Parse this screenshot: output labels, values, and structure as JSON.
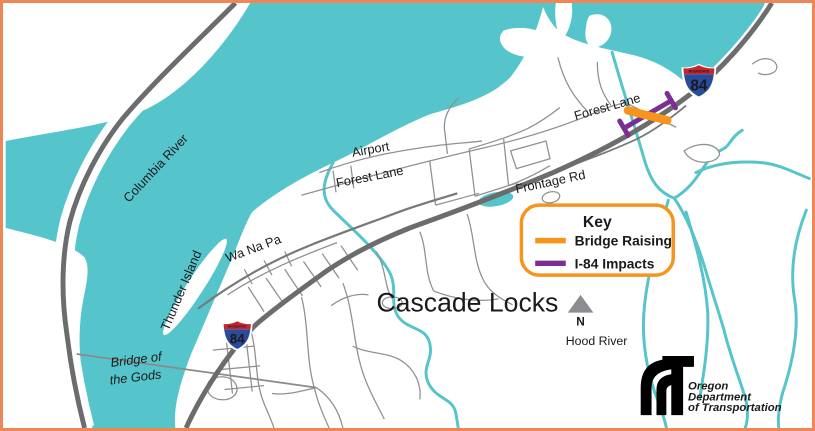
{
  "map": {
    "labels": {
      "columbia_river": "Columbia River",
      "thunder_island": "Thunder Island",
      "wa_na_pa": "Wa Na Pa",
      "airport": "Airport",
      "forest_lane_west": "Forest Lane",
      "forest_lane_northeast": "Forest Lane",
      "frontage_rd": "Frontage Rd",
      "bridge_of_the_gods_line1": "Bridge of",
      "bridge_of_the_gods_line2": "the Gods",
      "town": "Cascade Locks",
      "hood_river": "Hood River"
    },
    "north_arrow": {
      "label": "N"
    },
    "interstate_shield": {
      "top_text": "INTERSTATE",
      "number": "84"
    }
  },
  "key": {
    "title": "Key",
    "items": [
      {
        "label": "Bridge Raising",
        "color": "#F7941E"
      },
      {
        "label": "I-84 Impacts",
        "color": "#7C2E94"
      }
    ]
  },
  "logo": {
    "line1": "Oregon",
    "line2": "Department",
    "line3": "of Transportation"
  },
  "colors": {
    "water": "#55C5CB",
    "frame_border": "#EE8757",
    "highway_gray": "#6B6C6E",
    "minor_road_gray": "#8F9193",
    "bridge_raising_orange": "#F7941E",
    "i84_impacts_purple": "#7C2E94",
    "shield_red": "#C4272E",
    "shield_blue": "#2A4B9B"
  }
}
